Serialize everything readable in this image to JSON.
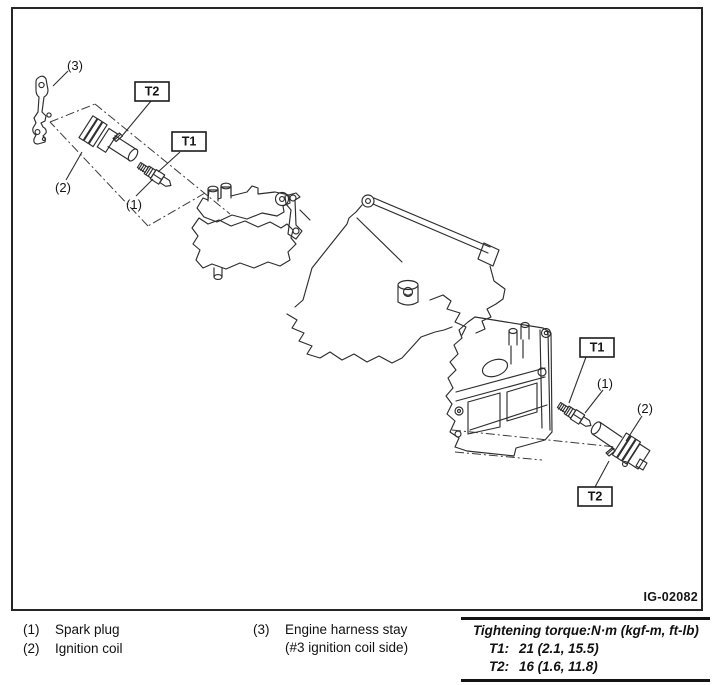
{
  "figure": {
    "code": "IG-02082",
    "callouts": {
      "t1": "T1",
      "t2": "T2",
      "n1": "(1)",
      "n2": "(2)",
      "n3": "(3)"
    }
  },
  "legend": {
    "items": [
      {
        "ref": "(1)",
        "label": "Spark plug"
      },
      {
        "ref": "(2)",
        "label": "Ignition coil"
      },
      {
        "ref": "(3)",
        "label": "Engine harness stay",
        "label_note": "(#3 ignition coil side)"
      }
    ]
  },
  "torque_table": {
    "header": "Tightening torque:N·m (kgf-m, ft-lb)",
    "rows": [
      {
        "key": "T1:",
        "value": "21 (2.1, 15.5)"
      },
      {
        "key": "T2:",
        "value": "16 (1.6, 11.8)"
      }
    ]
  }
}
